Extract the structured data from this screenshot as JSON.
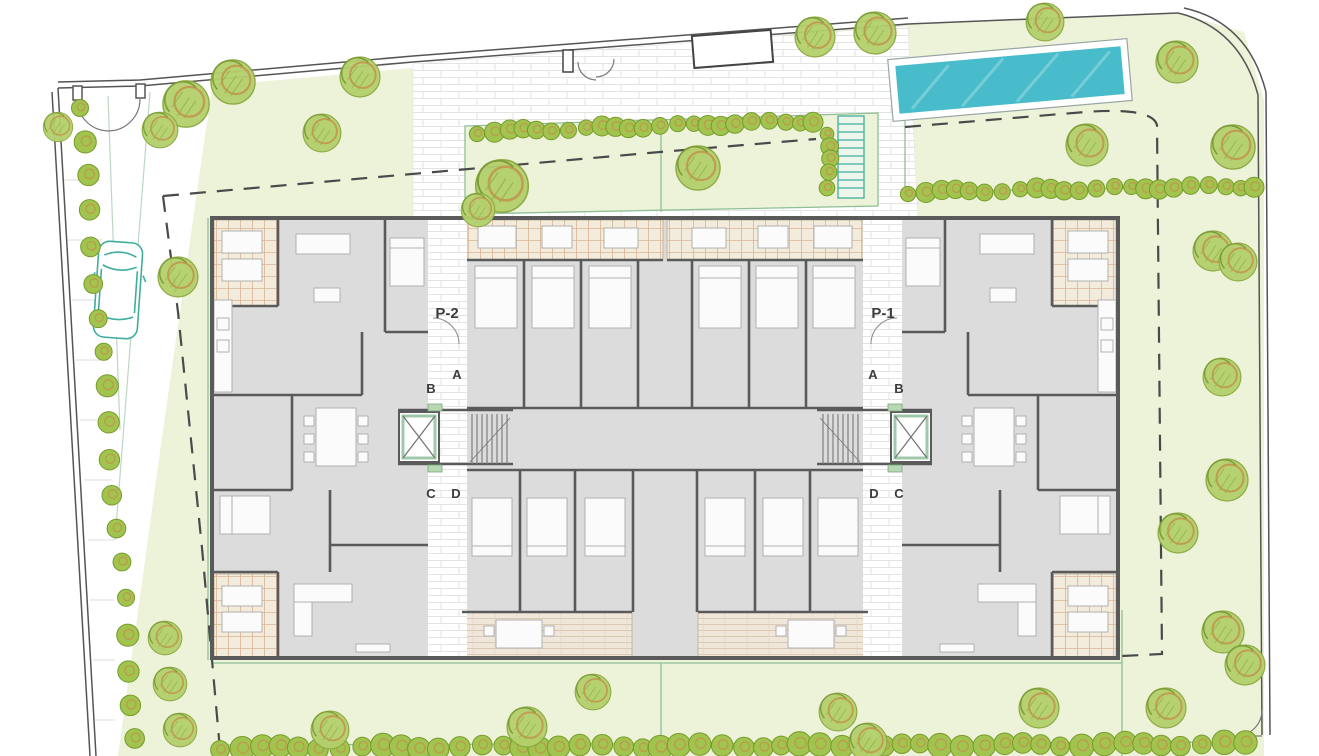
{
  "labels": {
    "p2": "P-2",
    "p1": "P-1",
    "a": "A",
    "b": "B",
    "c": "C",
    "d": "D"
  },
  "colors": {
    "lawn": "#edf3d8",
    "lawn_line": "#8fbf96",
    "tree_fill": "#b3d06c",
    "tree_stroke": "#8aa83f",
    "tree_accent": "#c1954c",
    "hedge_fill": "#a1c44f",
    "hedge_stroke": "#779a2c",
    "pool_water": "#48bccb",
    "pool_deck": "#ffffff",
    "wall": "#5a5a5a",
    "floor": "#dcdcdc",
    "terrace_tile": "#f3ecdd",
    "tile_line": "#d9b493",
    "deck": "#f0e7da",
    "boundary_dash": "#4a4a4a",
    "car_outline": "#3fae9e",
    "elevator_green": "#9fc9a8",
    "furniture": "#fbfbfb",
    "furniture_line": "#b0b0b0",
    "label_text": "#3c3c3c"
  },
  "site": {
    "trees": [
      [
        233,
        82,
        1.05
      ],
      [
        186,
        104,
        1.1
      ],
      [
        160,
        130,
        0.85
      ],
      [
        58,
        127,
        0.7
      ],
      [
        322,
        133,
        0.9
      ],
      [
        360,
        77,
        0.95
      ],
      [
        178,
        277,
        0.95
      ],
      [
        502,
        186,
        1.25
      ],
      [
        478,
        210,
        0.8
      ],
      [
        698,
        168,
        1.05
      ],
      [
        815,
        37,
        0.95
      ],
      [
        875,
        33,
        1.0
      ],
      [
        1045,
        22,
        0.9
      ],
      [
        1177,
        62,
        1.0
      ],
      [
        1087,
        145,
        1.0
      ],
      [
        1233,
        147,
        1.05
      ],
      [
        1213,
        251,
        0.95
      ],
      [
        1238,
        262,
        0.9
      ],
      [
        1222,
        377,
        0.9
      ],
      [
        1227,
        480,
        1.0
      ],
      [
        1178,
        533,
        0.95
      ],
      [
        1223,
        632,
        1.0
      ],
      [
        1245,
        665,
        0.95
      ],
      [
        1166,
        708,
        0.95
      ],
      [
        1039,
        708,
        0.95
      ],
      [
        838,
        712,
        0.9
      ],
      [
        868,
        742,
        0.9
      ],
      [
        593,
        692,
        0.85
      ],
      [
        527,
        727,
        0.95
      ],
      [
        330,
        730,
        0.9
      ],
      [
        165,
        638,
        0.8
      ],
      [
        170,
        684,
        0.8
      ],
      [
        180,
        730,
        0.8
      ]
    ],
    "hedge_rows": [
      {
        "x1": 80,
        "y1": 106,
        "x2": 136,
        "y2": 740,
        "n": 19,
        "r": 10
      },
      {
        "x1": 477,
        "y1": 132,
        "x2": 814,
        "y2": 121,
        "n": 23,
        "r": 9
      },
      {
        "x1": 827,
        "y1": 132,
        "x2": 829,
        "y2": 188,
        "n": 5,
        "r": 8
      },
      {
        "x1": 908,
        "y1": 192,
        "x2": 1255,
        "y2": 186,
        "n": 23,
        "r": 9
      },
      {
        "x1": 220,
        "y1": 748,
        "x2": 1243,
        "y2": 744,
        "n": 52,
        "r": 11
      }
    ]
  }
}
